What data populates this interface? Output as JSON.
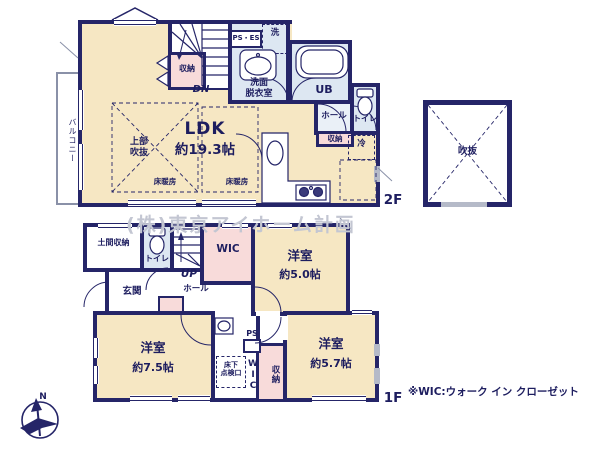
{
  "watermark": "(株)東京アイホーム計画",
  "note": "※WIC:ウォーク イン クローゼット",
  "compass": {
    "label": "N"
  },
  "floor2": {
    "label": "2F",
    "ldk_name": "LDK",
    "ldk_size": "約19.3帖",
    "balcony": "バルコニー",
    "upper_void": "上部\n吹抜",
    "floor_heating1": "床暖房",
    "floor_heating2": "床暖房",
    "storage_stairs": "収納",
    "dn": "DN",
    "ps_es": "PS・ES",
    "washer": "洗",
    "washroom": "洗面\n脱衣室",
    "bath": "UB",
    "hall": "ホール",
    "toilet": "トイレ",
    "storage_hall": "収納",
    "fridge": "冷",
    "void": "吹抜"
  },
  "floor1": {
    "label": "1F",
    "doma": "土間収納",
    "toilet": "トイレ",
    "up": "UP",
    "wic": "WIC",
    "bedroom_a_name": "洋室",
    "bedroom_a_size": "約5.0帖",
    "entrance": "玄関",
    "hall": "ホール",
    "bedroom_b_name": "洋室",
    "bedroom_b_size": "約7.5帖",
    "underfloor": "床下\n点検口",
    "wic_vertical": "WIC",
    "ps": "PS",
    "storage": "収納",
    "bedroom_c_name": "洋室",
    "bedroom_c_size": "約5.7帖"
  },
  "colors": {
    "wall_navy": "#252568",
    "room_cream": "#f6e7c3",
    "wet_blue": "#dde7f2",
    "hall_blue": "#eaf0f7",
    "closet_pink": "#f8dbda",
    "text_navy": "#1d1d5f",
    "watermark_gray": "#c3c6d2",
    "window_gray": "#b5bac8"
  }
}
